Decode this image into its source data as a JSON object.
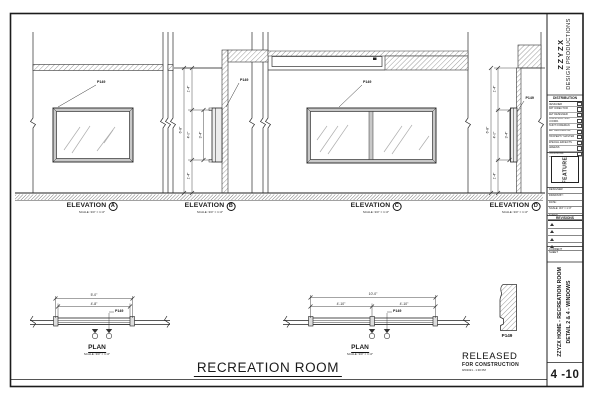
{
  "room_title": "RECREATION ROOM",
  "released": {
    "line1": "RELEASED",
    "line2": "FOR CONSTRUCTION",
    "stamp": "9/6/2021 - 1:30 PM"
  },
  "callout_label": "P149",
  "molding_label": "P149",
  "views": {
    "elevation_label": "ELEVATION",
    "plan_label": "PLAN",
    "scale_note": "SCALE: 3/4\" = 1'-0\"",
    "letters": [
      "A",
      "B",
      "C",
      "D"
    ]
  },
  "dims": {
    "elev_b": {
      "top": "1'-4\"",
      "overall": "6'-8\"",
      "window": "4'-0\"",
      "inner": "3'-4\"",
      "bottom": "1'-4\""
    },
    "elev_d": {
      "top": "1'-4\"",
      "overall": "6'-8\"",
      "window": "4'-0\"",
      "inner": "3'-4\"",
      "bottom": "1'-4\""
    },
    "plan_1": {
      "overall": "5'-0\"",
      "inner": "4'-8\""
    },
    "plan_2": {
      "overall": "10'-0\"",
      "left": "4'-10\"",
      "right": "4'-10\""
    }
  },
  "titleblock": {
    "company": {
      "line1": "ZZYZX",
      "line2": "DESIGN PRODUCTIONS"
    },
    "distribution": {
      "header": "DISTRIBUTION",
      "rows": [
        "PRODUCTION DESIGNER",
        "ART DIRECTOR",
        "SET DESIGNER",
        "CONSTRUCTION COORD.",
        "PAINT FOREMAN",
        "SET DECORATOR",
        "PROPERTY MASTER",
        "SPECIAL EFFECTS",
        "GREENS",
        "LOCATIONS"
      ]
    },
    "feature": "FEATURE",
    "info_rows": [
      "DESIGNER:",
      "DRAWN BY:",
      "DATE:",
      "SCALE: 3/4\" = 1'-0\"",
      "SHEET:"
    ],
    "revisions": {
      "header": "REVISIONS"
    },
    "current": {
      "line1": "CURRENT",
      "line2": "SHEET"
    },
    "project": {
      "line1": "ZZYZX HOME - RECREATION ROOM",
      "line2": "DETAIL 2 & 4 - WINDOWS"
    },
    "sheet_number": "4 -10"
  }
}
